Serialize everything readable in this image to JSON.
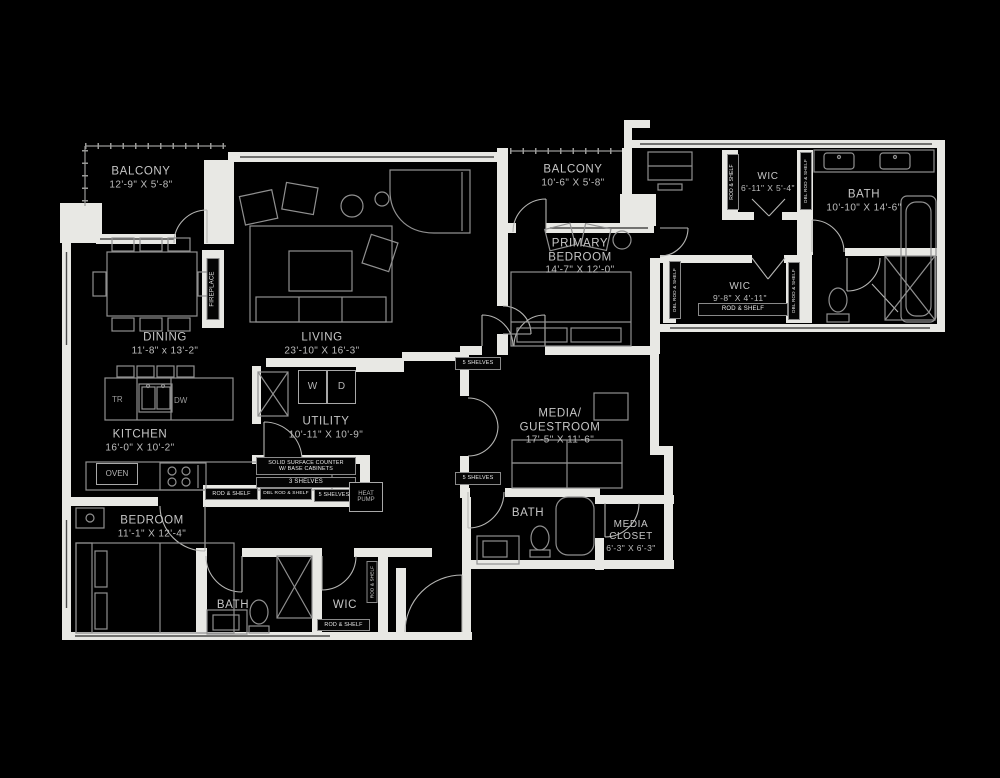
{
  "meta": {
    "type": "apartment floor plan",
    "background": "#000000"
  },
  "colors": {
    "background": "#000000",
    "walls": "#e8e8e4",
    "furniture_outline": "#909090",
    "door_arc": "#b5b5b3",
    "room_text": "#c6c6c6",
    "tag_text": "#ededed"
  },
  "rooms": {
    "balcony_left": {
      "name": "BALCONY",
      "dims": "12'-9\" X 5'-8\""
    },
    "balcony_right": {
      "name": "BALCONY",
      "dims": "10'-6\" X 5'-8\""
    },
    "primary_bedroom": {
      "name": "PRIMARY BEDROOM",
      "dims": "14'-7\" X 12'-0\""
    },
    "wic_primary_small": {
      "name": "WIC",
      "dims": "6'-11\" X 5'-4\""
    },
    "primary_bath": {
      "name": "BATH",
      "dims": "10'-10\" X 14'-6\""
    },
    "wic_primary_large": {
      "name": "WIC",
      "dims": "9'-8\" X 4'-11\""
    },
    "dining": {
      "name": "DINING",
      "dims": "11'-8\" x 13'-2\""
    },
    "living": {
      "name": "LIVING",
      "dims": "23'-10\" X 16'-3\""
    },
    "utility": {
      "name": "UTILITY",
      "dims": "10'-11\" X 10'-9\""
    },
    "kitchen": {
      "name": "KITCHEN",
      "dims": "16'-0\" X 10'-2\""
    },
    "media_guestroom": {
      "name": "MEDIA/ GUESTROOM",
      "dims": "17'-5\" X 11'-6\""
    },
    "bedroom2": {
      "name": "BEDROOM",
      "dims": "11'-1\" X 12'-4\""
    },
    "guest_bath": {
      "name": "BATH"
    },
    "media_closet": {
      "name": "MEDIA CLOSET",
      "dims": "6'-3\" X 6'-3\""
    },
    "bath2": {
      "name": "BATH"
    },
    "wic2": {
      "name": "WIC"
    }
  },
  "fixtures": {
    "rod_shelf": "ROD & SHELF",
    "dbl_rod_shelf": "DBL ROD & SHELF",
    "shelves3": "3 SHELVES",
    "shelves5": "5 SHELVES",
    "counter_line1": "SOLID SURFACE COUNTER",
    "counter_line2": "W/ BASE CABINETS",
    "heat_pump": "HEAT PUMP",
    "fireplace": "FIREPLACE",
    "oven": "OVEN",
    "washer": "W",
    "dryer": "D",
    "trash": "TR",
    "dishwasher": "DW"
  }
}
